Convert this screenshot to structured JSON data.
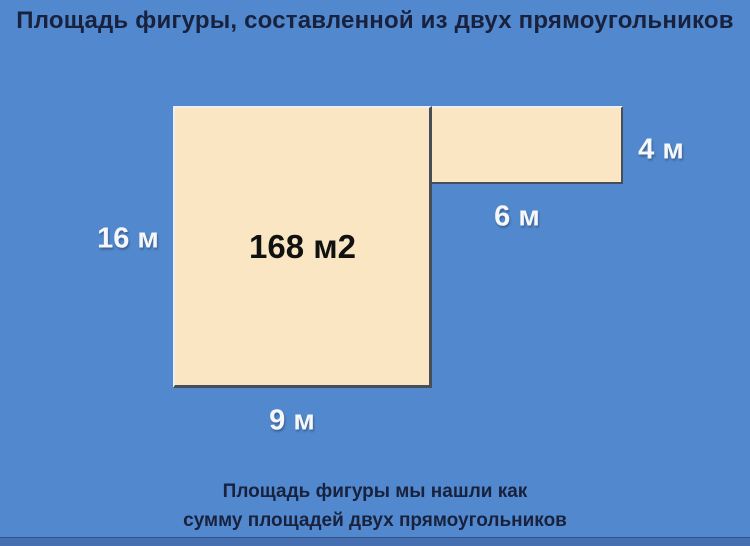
{
  "title": "Площадь фигуры, составленной из двух прямоугольников",
  "figure": {
    "area_label": "168 м2",
    "labels": {
      "height_large": "16 м",
      "width_large": "9 м",
      "width_small": "6 м",
      "height_small": "4 м"
    },
    "values": {
      "large_rect": {
        "width_m": 9,
        "height_m": 16
      },
      "small_rect": {
        "width_m": 6,
        "height_m": 4
      },
      "total_area_m2": 168
    }
  },
  "caption": {
    "line1": "Площадь фигуры мы нашли как",
    "line2": "сумму площадей двух прямоугольников"
  },
  "colors": {
    "background": "#5289ce",
    "rect_fill": "#fae6c2",
    "border_dark": "#474d59",
    "border_light": "#edf0f2",
    "label_text": "#f5f7fa",
    "area_text": "#111111",
    "heading_text": "#18213d",
    "footer_strip": "#456fb0"
  }
}
